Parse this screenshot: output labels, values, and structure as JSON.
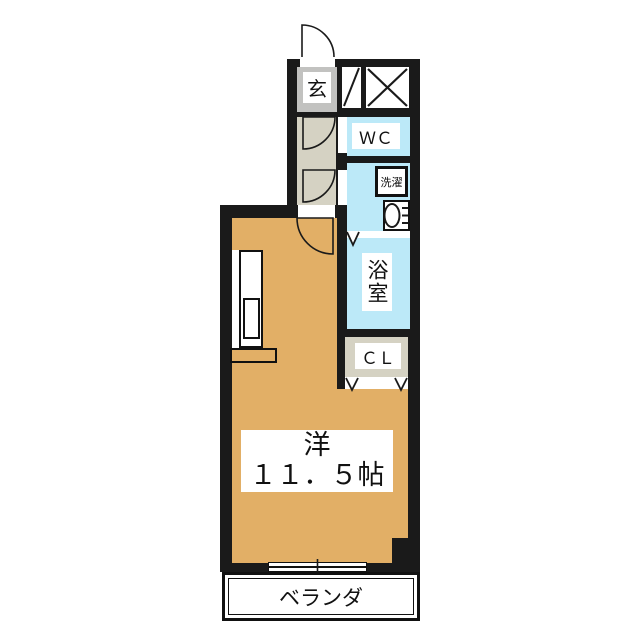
{
  "floorplan": {
    "type": "apartment-floor-plan",
    "rooms": {
      "entrance": {
        "label": "玄"
      },
      "wc": {
        "label": "ＷＣ"
      },
      "laundry": {
        "label": "洗濯"
      },
      "bathroom": {
        "label": "浴室"
      },
      "closet": {
        "label": "ＣＬ"
      },
      "main_room": {
        "name": "洋",
        "size": "１１．５帖"
      },
      "balcony": {
        "label": "ベランダ"
      }
    },
    "icons": [
      "entrance-door-arc-icon",
      "hallway-door-arc-icon",
      "room-door-arc-icon",
      "cross-brace-icon",
      "diagonal-shaft-icon",
      "washbasin-icon",
      "washing-machine-box",
      "kitchen-counter",
      "folding-door-icon",
      "sliding-window-icon"
    ],
    "colors": {
      "wall": "#1a1a1a",
      "room_floor": "#e2af66",
      "wet_area": "#bce9f8",
      "hallway_floor": "#d5d2c3",
      "entrance_floor": "#c2c2c0",
      "closet_floor": "#d5d2c3",
      "background": "#ffffff"
    }
  }
}
